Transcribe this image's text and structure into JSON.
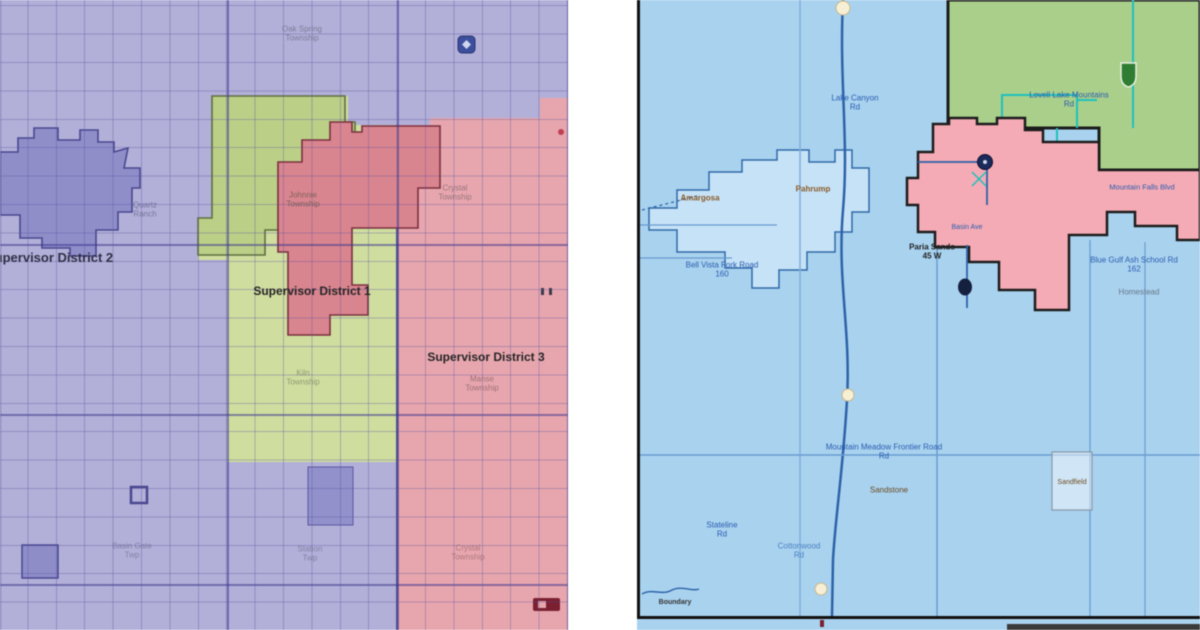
{
  "left_map": {
    "title_labels": {
      "district2": "Supervisor District 2",
      "district1": "Supervisor District 1",
      "district3": "Supervisor District 3"
    },
    "faint_labels": [
      {
        "l1": "Oak Spring",
        "l2": "Township"
      },
      {
        "l1": "Crystal",
        "l2": "Township"
      },
      {
        "l1": "Quartz",
        "l2": "Ranch"
      },
      {
        "l1": "Johnnie",
        "l2": "Township"
      },
      {
        "l1": "Kiln",
        "l2": "Township"
      },
      {
        "l1": "Manse",
        "l2": "Township"
      },
      {
        "l1": "Basin Gate",
        "l2": "Twp"
      },
      {
        "l1": "Station",
        "l2": "Twp"
      },
      {
        "l1": "Crystal",
        "l2": "Township"
      }
    ],
    "colors": {
      "district2_purple": "#b2b0d8",
      "district1_green": "#cfdd9f",
      "district3_pink": "#e7a6ae",
      "town_purple": "#908ec9",
      "town_green": "#bccf87",
      "town_red": "#d9858f"
    }
  },
  "right_map": {
    "labels": {
      "lake_canyon": {
        "l1": "Lake Canyon",
        "l2": "Rd"
      },
      "mountain_area": {
        "l1": "Lovell Lake Mountains",
        "l2": "Rd"
      },
      "town_west": "Amargosa",
      "town_center": "Pahrump",
      "dark_junction": {
        "l1": "Paria Sands",
        "l2": "45 W"
      },
      "bell_vista": {
        "l1": "Bell Vista Fork Road",
        "l2": "160"
      },
      "frontier_road": {
        "l1": "Mountain Meadow Frontier Road",
        "l2": "Rd"
      },
      "sandstone": "Sandstone",
      "school_road": {
        "l1": "Blue Gulf Ash School Rd",
        "l2": "162"
      },
      "mountain_falls": "Mountain Falls Blvd",
      "homestead": "Homestead",
      "basin_ave": "Basin Ave",
      "stateline": {
        "l1": "Stateline",
        "l2": "Rd"
      },
      "cottonwood": {
        "l1": "Cottonwood",
        "l2": "Rd"
      },
      "boundary": "Boundary",
      "sandfield": "Sandfield"
    },
    "colors": {
      "background_blue": "#a9d2ef",
      "region_green": "#a9cf8b",
      "region_pink": "#f5abb5",
      "road_blue": "#2d62a8",
      "label_blue": "#2a5cae",
      "town_brown": "#8a5a28"
    }
  }
}
